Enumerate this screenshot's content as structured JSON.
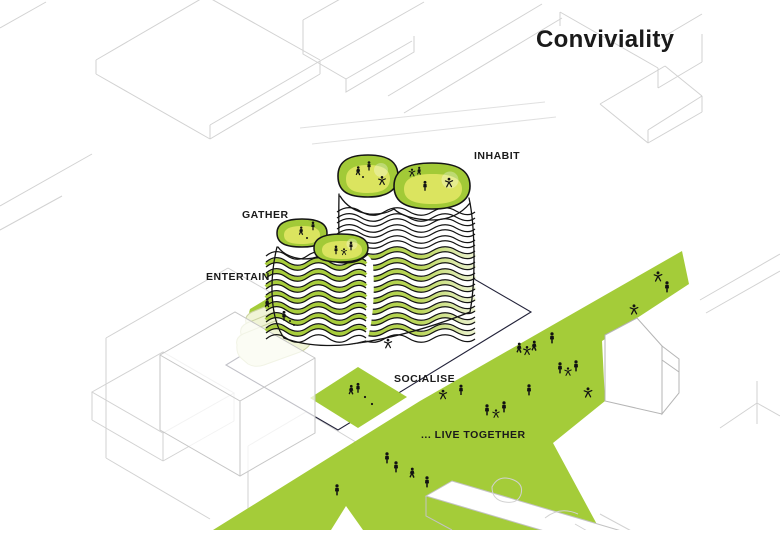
{
  "title": "Conviviality",
  "annotations": {
    "gather": "GATHER",
    "inhabit": "INHABIT",
    "entertain": "ENTERTAIN",
    "socialise": "SOCIALISE",
    "live_together": "... LIVE TOGETHER"
  },
  "diagram": {
    "type": "architectural-concept-axonometric",
    "subject": "wavy terraced tower with rooftop gardens beside a green public corridor",
    "people_figures_count": 33
  },
  "palette": {
    "green": "#a4cc39",
    "roof_green": "#a2ca37",
    "roof_inner": "#dbe45f",
    "pale_plate": "#f0f4d6",
    "figure_black": "#121212",
    "wireframe_gray": "#d2d2d2",
    "site_outline": "#23233a"
  }
}
